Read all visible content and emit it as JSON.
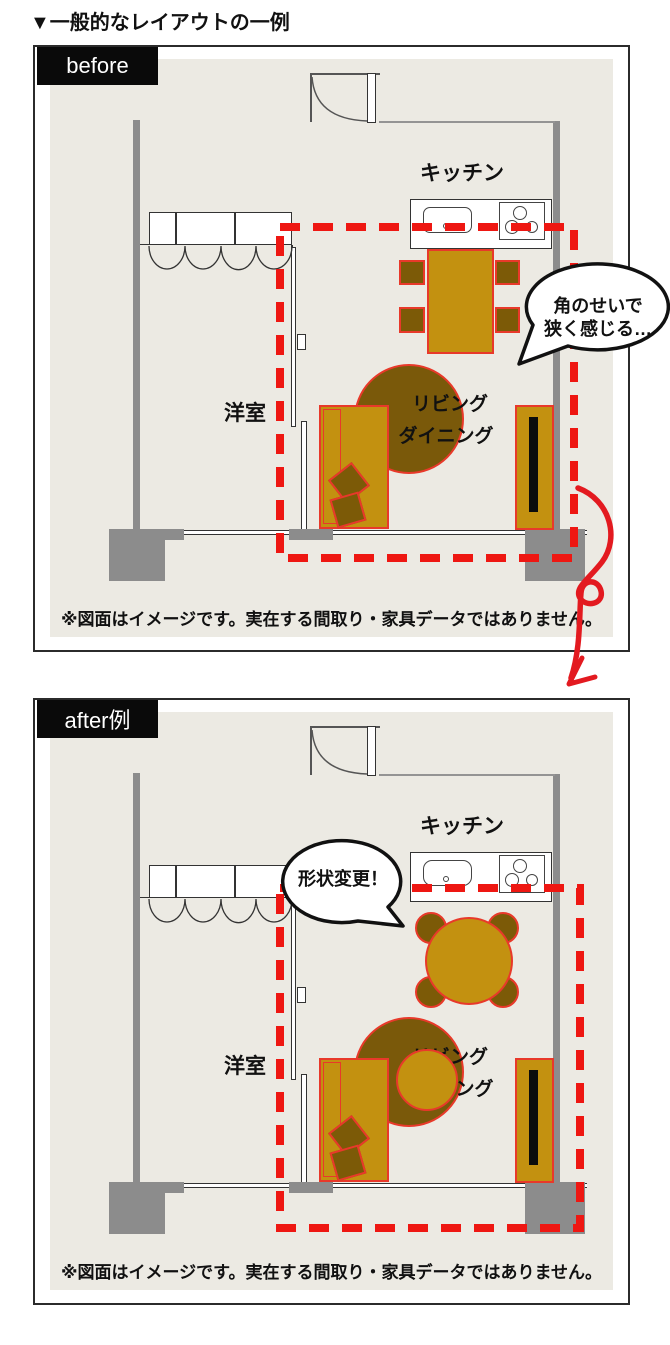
{
  "title": "▼一般的なレイアウトの一例",
  "panels": {
    "before": {
      "label": "before",
      "kitchen_label": "キッチン",
      "western_room_label": "洋室",
      "living_label_line1": "リビング",
      "living_label_line2": "ダイニング",
      "bubble_line1": "角のせいで",
      "bubble_line2": "狭く感じる…",
      "disclaimer": "※図面はイメージです。実在する間取り・家具データではありません。"
    },
    "after": {
      "label": "after例",
      "kitchen_label": "キッチン",
      "western_room_label": "洋室",
      "living_label_line1": "リビング",
      "living_label_line2": "ダイニング",
      "bubble_text": "形状変更！",
      "disclaimer": "※図面はイメージです。実在する間取り・家具データではありません。"
    }
  },
  "colors": {
    "floor": "#ECEAE3",
    "wall_gray": "#8C8C8C",
    "furniture_gold": "#C39110",
    "furniture_dark": "#7C5A07",
    "outline_red": "#E8392A",
    "dash_red": "#EE1712",
    "arrow_red": "#E31A20",
    "label_bg": "#0A0A0A"
  }
}
